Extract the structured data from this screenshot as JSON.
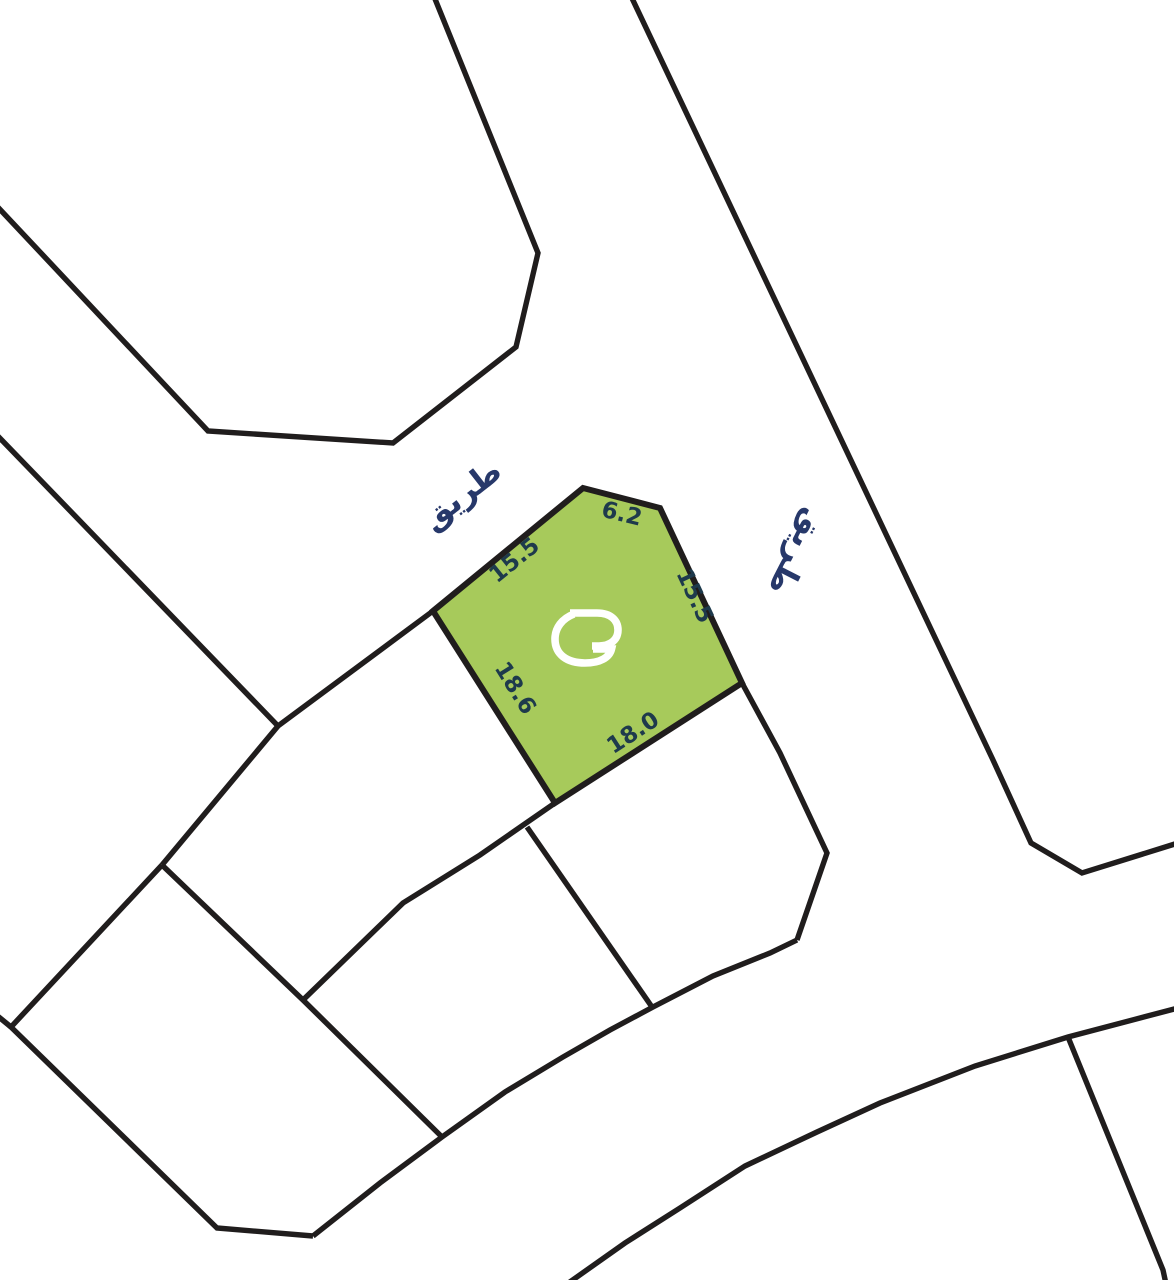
{
  "map": {
    "type": "cadastral-parcel-map",
    "road_labels": [
      {
        "text": "طريق"
      },
      {
        "text": "طريق"
      }
    ],
    "selected_parcel": {
      "dimensions": {
        "nw_edge": "15.5",
        "top_edge": "6.2",
        "ne_edge": "15.5",
        "west_edge": "18.6",
        "south_edge": "18.0"
      }
    },
    "colors": {
      "background": "#ffffff",
      "boundary_line": "#201d1d",
      "parcel_fill": "#a7ca5b",
      "road_label_text": "#27386a",
      "dimension_text": "#1e3a4c",
      "logo": "#ffffff"
    }
  }
}
